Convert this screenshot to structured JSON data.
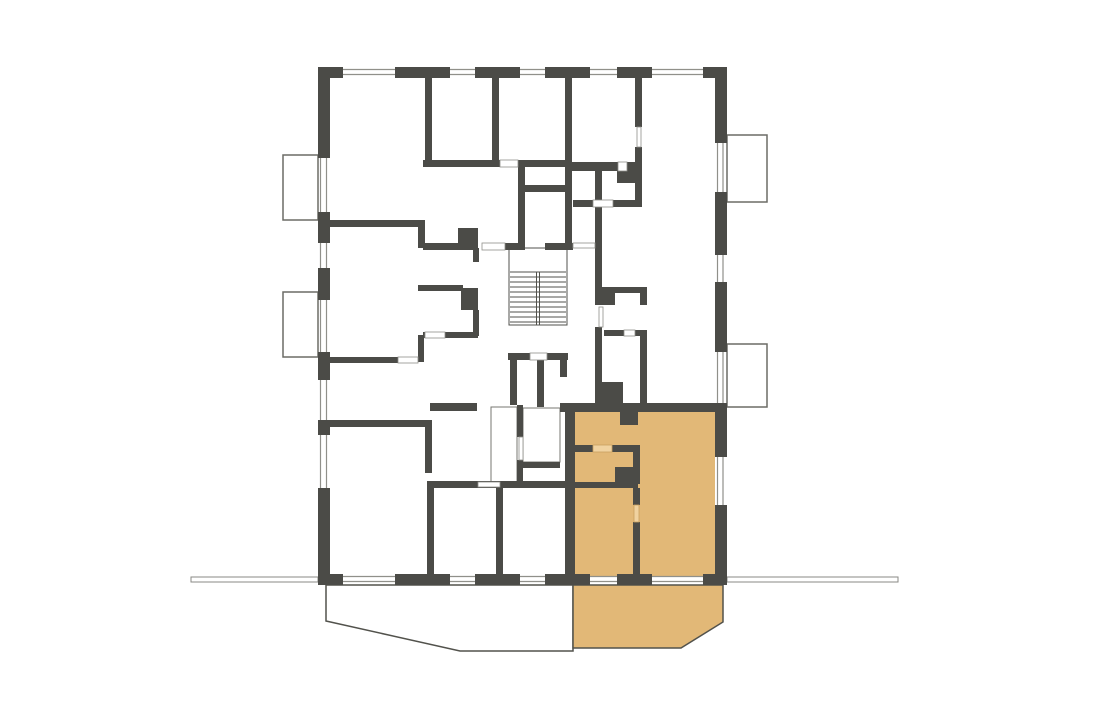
{
  "page": {
    "background": "#ffffff"
  },
  "plan": {
    "canvas": {
      "width": 1094,
      "height": 713
    },
    "colors": {
      "wall": "#4b4b47",
      "hairline": "#90908a",
      "thin_outline": "#777771",
      "balcony_outline": "#6c6c66",
      "terrace_outline": "#52524c",
      "stair_line": "#52524c",
      "ground_stroke": "#8a8a84",
      "white": "#ffffff",
      "unit_fill": "#e2b877",
      "unit_door": "#f0d2a0",
      "unit_door_edge": "#c9a05f"
    },
    "walls": [
      [
        320,
        67,
        23,
        11
      ],
      [
        395,
        67,
        55,
        11
      ],
      [
        475,
        67,
        45,
        11
      ],
      [
        545,
        67,
        45,
        11
      ],
      [
        617,
        67,
        35,
        11
      ],
      [
        703,
        67,
        24,
        11
      ],
      [
        320,
        574,
        23,
        11
      ],
      [
        395,
        574,
        55,
        11
      ],
      [
        475,
        574,
        45,
        11
      ],
      [
        545,
        574,
        45,
        11
      ],
      [
        617,
        574,
        35,
        11
      ],
      [
        703,
        574,
        24,
        11
      ],
      [
        318,
        67,
        12,
        91
      ],
      [
        318,
        212,
        12,
        31
      ],
      [
        318,
        268,
        12,
        32
      ],
      [
        318,
        352,
        12,
        28
      ],
      [
        318,
        420,
        12,
        15
      ],
      [
        318,
        488,
        12,
        97
      ],
      [
        715,
        67,
        12,
        76
      ],
      [
        715,
        192,
        12,
        63
      ],
      [
        715,
        282,
        12,
        70
      ],
      [
        715,
        403,
        12,
        54
      ],
      [
        715,
        505,
        12,
        80
      ],
      [
        425,
        77,
        7,
        86
      ],
      [
        492,
        77,
        7,
        86
      ],
      [
        565,
        77,
        7,
        173
      ],
      [
        635,
        77,
        7,
        50
      ],
      [
        635,
        147,
        7,
        60
      ],
      [
        423,
        160,
        77,
        7
      ],
      [
        518,
        160,
        47,
        7
      ],
      [
        572,
        162,
        46,
        9
      ],
      [
        617,
        162,
        18,
        21
      ],
      [
        573,
        200,
        20,
        7
      ],
      [
        613,
        200,
        29,
        7
      ],
      [
        595,
        163,
        7,
        124
      ],
      [
        595,
        327,
        7,
        76
      ],
      [
        595,
        382,
        28,
        21
      ],
      [
        595,
        287,
        52,
        6
      ],
      [
        640,
        287,
        7,
        18
      ],
      [
        595,
        293,
        20,
        12
      ],
      [
        604,
        330,
        20,
        6
      ],
      [
        635,
        330,
        10,
        6
      ],
      [
        640,
        330,
        7,
        73
      ],
      [
        518,
        163,
        7,
        87
      ],
      [
        525,
        185,
        42,
        7
      ],
      [
        423,
        243,
        54,
        7
      ],
      [
        458,
        228,
        20,
        20
      ],
      [
        505,
        243,
        13,
        7
      ],
      [
        545,
        243,
        28,
        7
      ],
      [
        330,
        220,
        91,
        7
      ],
      [
        418,
        220,
        7,
        28
      ],
      [
        418,
        285,
        45,
        6
      ],
      [
        461,
        288,
        17,
        22
      ],
      [
        473,
        248,
        6,
        14
      ],
      [
        473,
        310,
        6,
        26
      ],
      [
        423,
        332,
        55,
        6
      ],
      [
        418,
        335,
        6,
        27
      ],
      [
        330,
        357,
        68,
        6
      ],
      [
        330,
        420,
        95,
        7
      ],
      [
        425,
        420,
        7,
        53
      ],
      [
        427,
        481,
        138,
        7
      ],
      [
        427,
        488,
        7,
        87
      ],
      [
        496,
        488,
        7,
        87
      ],
      [
        508,
        353,
        22,
        7
      ],
      [
        547,
        353,
        21,
        7
      ],
      [
        510,
        360,
        7,
        45
      ],
      [
        537,
        353,
        7,
        54
      ],
      [
        560,
        353,
        7,
        24
      ],
      [
        517,
        405,
        6,
        32
      ],
      [
        517,
        460,
        6,
        27
      ],
      [
        517,
        462,
        43,
        6
      ],
      [
        430,
        403,
        47,
        8
      ],
      [
        560,
        403,
        167,
        9
      ],
      [
        620,
        412,
        18,
        13
      ],
      [
        565,
        405,
        10,
        172
      ],
      [
        573,
        445,
        20,
        7
      ],
      [
        612,
        445,
        28,
        7
      ],
      [
        573,
        482,
        60,
        6
      ],
      [
        633,
        452,
        7,
        32
      ],
      [
        633,
        488,
        7,
        17
      ],
      [
        633,
        522,
        7,
        53
      ],
      [
        615,
        467,
        23,
        21
      ]
    ],
    "window_hairlines": [
      [
        343,
        69.5,
        395,
        69.5
      ],
      [
        343,
        74.5,
        395,
        74.5
      ],
      [
        450,
        69.5,
        475,
        69.5
      ],
      [
        450,
        74.5,
        475,
        74.5
      ],
      [
        520,
        69.5,
        545,
        69.5
      ],
      [
        520,
        74.5,
        545,
        74.5
      ],
      [
        590,
        69.5,
        617,
        69.5
      ],
      [
        590,
        74.5,
        617,
        74.5
      ],
      [
        652,
        69.5,
        703,
        69.5
      ],
      [
        652,
        74.5,
        703,
        74.5
      ],
      [
        343,
        576.5,
        395,
        576.5
      ],
      [
        343,
        581.5,
        395,
        581.5
      ],
      [
        450,
        576.5,
        475,
        576.5
      ],
      [
        450,
        581.5,
        475,
        581.5
      ],
      [
        520,
        576.5,
        545,
        576.5
      ],
      [
        520,
        581.5,
        545,
        581.5
      ],
      [
        590,
        576.5,
        617,
        576.5
      ],
      [
        590,
        581.5,
        617,
        581.5
      ],
      [
        652,
        576.5,
        703,
        576.5
      ],
      [
        652,
        581.5,
        703,
        581.5
      ],
      [
        320.5,
        158,
        320.5,
        212
      ],
      [
        326.5,
        158,
        326.5,
        212
      ],
      [
        320.5,
        243,
        320.5,
        268
      ],
      [
        326.5,
        243,
        326.5,
        268
      ],
      [
        320.5,
        300,
        320.5,
        352
      ],
      [
        326.5,
        300,
        326.5,
        352
      ],
      [
        320.5,
        380,
        320.5,
        420
      ],
      [
        326.5,
        380,
        326.5,
        420
      ],
      [
        320.5,
        435,
        320.5,
        488
      ],
      [
        326.5,
        435,
        326.5,
        488
      ],
      [
        717.5,
        143,
        717.5,
        192
      ],
      [
        723,
        143,
        723,
        192
      ],
      [
        717.5,
        255,
        717.5,
        282
      ],
      [
        723,
        255,
        723,
        282
      ],
      [
        717.5,
        352,
        717.5,
        403
      ],
      [
        723,
        352,
        723,
        403
      ],
      [
        717.5,
        457,
        717.5,
        505
      ],
      [
        723,
        457,
        723,
        505
      ]
    ],
    "door_slots": [
      [
        500,
        160,
        18,
        7
      ],
      [
        618,
        162,
        9,
        9
      ],
      [
        593,
        200,
        20,
        7
      ],
      [
        482,
        243,
        23,
        7
      ],
      [
        573,
        243,
        22,
        5
      ],
      [
        398,
        357,
        20,
        6
      ],
      [
        425,
        332,
        20,
        6
      ],
      [
        478,
        482,
        22,
        5
      ],
      [
        530,
        353,
        17,
        7
      ],
      [
        624,
        330,
        11,
        6
      ],
      [
        519,
        437,
        4,
        23
      ],
      [
        599,
        307,
        4,
        20
      ],
      [
        637,
        127,
        4,
        20
      ]
    ],
    "unit_door_slots": [
      [
        593,
        445,
        19,
        7
      ],
      [
        634,
        505,
        5,
        17
      ]
    ],
    "thin_rooms": [
      [
        491,
        407,
        26,
        77
      ],
      [
        523,
        408,
        37,
        54
      ]
    ],
    "balconies": [
      [
        283,
        155,
        35,
        65
      ],
      [
        283,
        292,
        35,
        65
      ],
      [
        727,
        135,
        40,
        67
      ],
      [
        727,
        344,
        40,
        63
      ]
    ],
    "stairs": {
      "outline": [
        509,
        248,
        58,
        77
      ],
      "treads": [
        [
          510,
          272,
          566,
          272
        ],
        [
          510,
          277,
          566,
          277
        ],
        [
          510,
          282,
          566,
          282
        ],
        [
          510,
          287,
          566,
          287
        ],
        [
          510,
          292,
          566,
          292
        ],
        [
          510,
          297,
          566,
          297
        ],
        [
          510,
          302,
          566,
          302
        ],
        [
          510,
          307,
          566,
          307
        ],
        [
          510,
          312,
          566,
          312
        ],
        [
          510,
          317,
          566,
          317
        ],
        [
          510,
          322,
          566,
          322
        ]
      ],
      "divider": [
        [
          536.5,
          272,
          536.5,
          325
        ],
        [
          539.5,
          272,
          539.5,
          325
        ]
      ]
    },
    "terrace_left_points": "326,585 326,621 460,651 573,651 573,585",
    "highlighted_unit": {
      "fill_rect": [
        566,
        406,
        149,
        170
      ],
      "terrace_points": "573,585 573,648 681,648 723,622 723,585"
    },
    "ground_segments": [
      [
        191,
        577,
        127,
        5
      ],
      [
        727,
        577,
        171,
        5
      ]
    ]
  }
}
